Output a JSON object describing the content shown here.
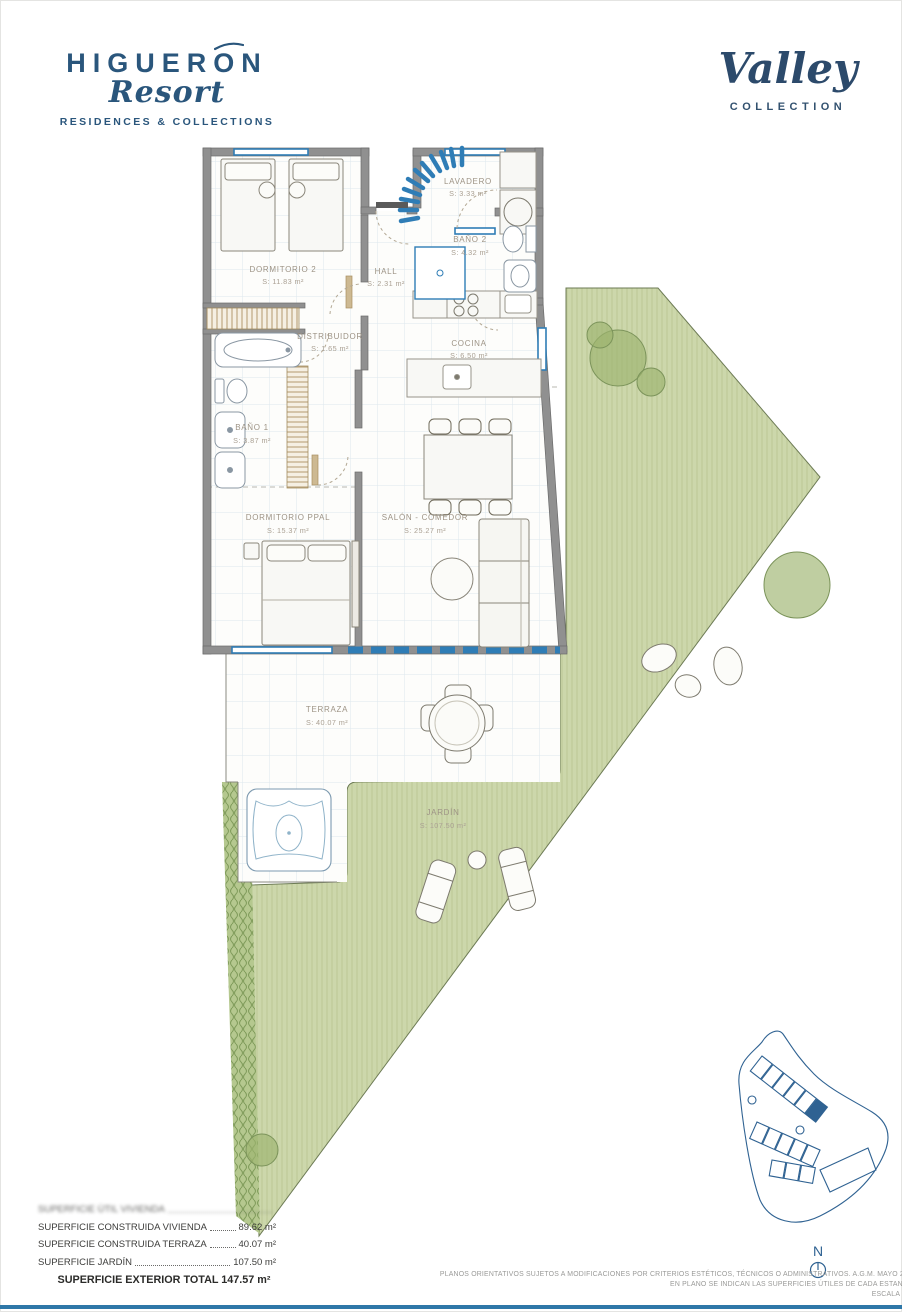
{
  "header": {
    "brand": {
      "name": "HIGUERON",
      "script": "Resort",
      "tagline": "RESIDENCES & COLLECTIONS"
    },
    "collection": {
      "name": "Valley",
      "sub": "COLLECTION"
    }
  },
  "floorplan": {
    "rooms": [
      {
        "name": "LAVADERO",
        "area": "S: 3.33 m²"
      },
      {
        "name": "BAÑO 2",
        "area": "S: 4.32 m²"
      },
      {
        "name": "HALL",
        "area": "S: 2.31 m²"
      },
      {
        "name": "DORMITORIO 2",
        "area": "S: 11.83 m²"
      },
      {
        "name": "DISTRIBUIDOR",
        "area": "S: 1.65 m²"
      },
      {
        "name": "COCINA",
        "area": "S: 6.50 m²"
      },
      {
        "name": "BAÑO 1",
        "area": "S: 3.87 m²"
      },
      {
        "name": "DORMITORIO PPAL",
        "area": "S: 15.37 m²"
      },
      {
        "name": "SALÓN - COMEDOR",
        "area": "S: 25.27 m²"
      },
      {
        "name": "TERRAZA",
        "area": "S: 40.07 m²"
      },
      {
        "name": "JARDÍN",
        "area": "S: 107.50 m²"
      }
    ]
  },
  "surfaces": {
    "rows": [
      {
        "label": "SUPERFICIE ÚTIL VIVIENDA",
        "value": ""
      },
      {
        "label": "SUPERFICIE CONSTRUIDA VIVIENDA",
        "value": "89.62 m²"
      },
      {
        "label": "SUPERFICIE CONSTRUIDA TERRAZA",
        "value": "40.07 m²"
      },
      {
        "label": "SUPERFICIE JARDÍN",
        "value": "107.50 m²"
      }
    ],
    "total": "SUPERFICIE EXTERIOR TOTAL 147.57 m²"
  },
  "footnotes": {
    "line1": "PLANOS ORIENTATIVOS SUJETOS A MODIFICACIONES POR CRITERIOS ESTÉTICOS, TÉCNICOS O ADMINISTRATIVOS. A.G.M. MAYO 20",
    "line2": "EN PLANO SE INDICAN LAS SUPERFICIES ÚTILES DE CADA ESTANC",
    "line3": "ESCALA 1:"
  },
  "sitemap": {
    "north_label": "N"
  },
  "colors": {
    "brand_navy": "#2a567c",
    "window_blue": "#2f7db6",
    "wall_gray": "#909090",
    "garden_green": "#ccd7ab",
    "siteplan_blue": "#2f6292"
  }
}
